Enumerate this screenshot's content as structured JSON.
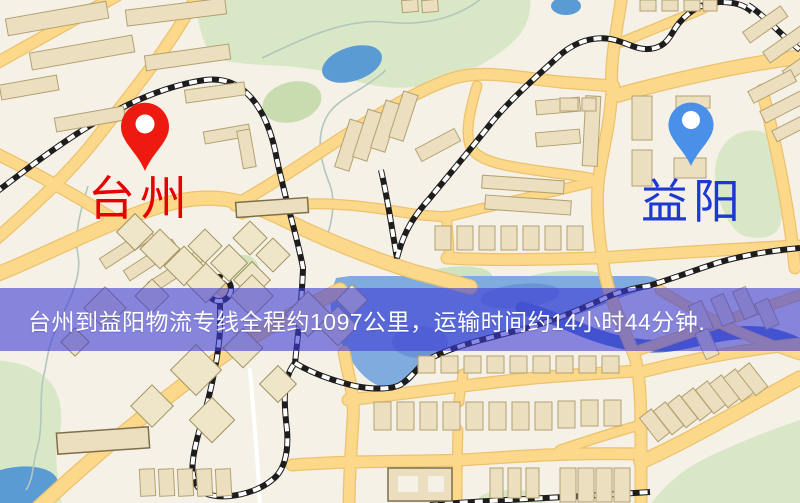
{
  "map": {
    "origin": {
      "label": "台州",
      "pin_color": "#ee1a10",
      "label_color": "#e60000",
      "pin_icon": "map-pin"
    },
    "destination": {
      "label": "益阳",
      "pin_color": "#4a8fe8",
      "label_color": "#1d39d4",
      "pin_icon": "map-pin"
    }
  },
  "banner": {
    "text": "台州到益阳物流专线全程约1097公里，运输时间约14小时44分钟.",
    "background": "rgba(62,60,213,0.60)",
    "text_color": "#ffffff"
  }
}
